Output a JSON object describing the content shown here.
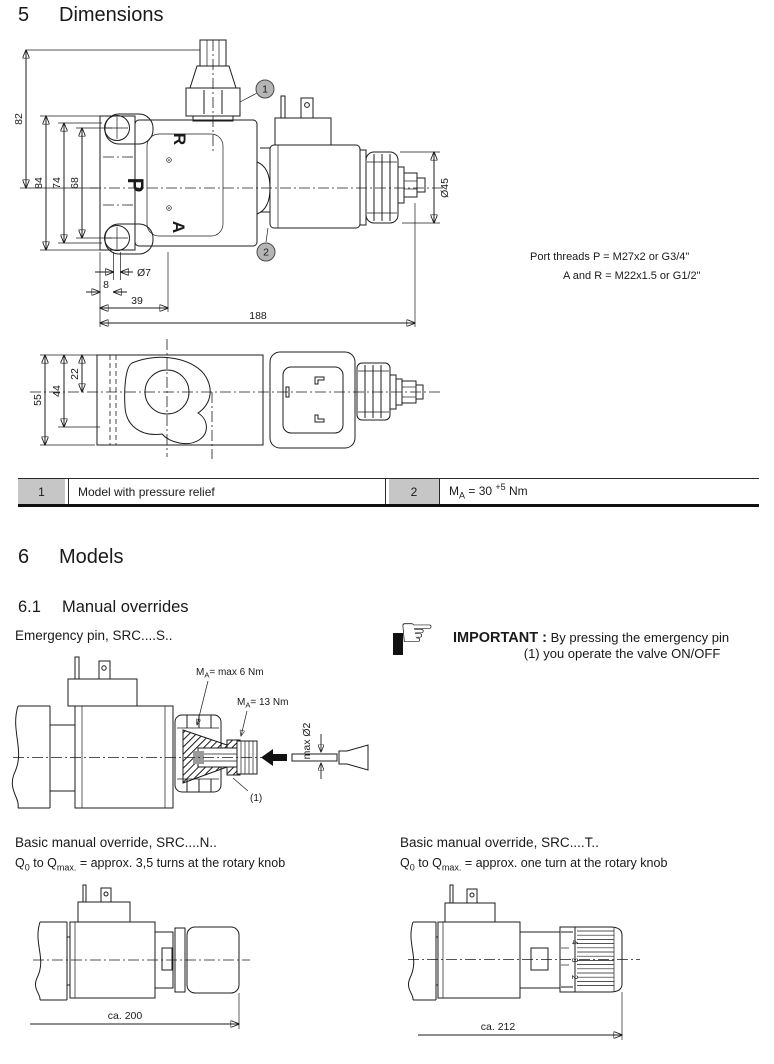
{
  "section5": {
    "number": "5",
    "title": "Dimensions"
  },
  "fig_front": {
    "dims": {
      "d82": "82",
      "d84": "84",
      "d74": "74",
      "d68": "68",
      "dia7": "Ø7",
      "d8": "8",
      "d39": "39",
      "d188": "188",
      "dia45": "Ø45"
    },
    "ports": {
      "r": "R",
      "p": "P",
      "a": "A"
    },
    "callout1": "1",
    "callout2": "2"
  },
  "port_threads": {
    "line1": "Port threads P = M27x2 or G3/4\"",
    "line2": "A and R = M22x1.5 or G1/2\""
  },
  "fig_top": {
    "dims": {
      "d55": "55",
      "d44": "44",
      "d22": "22"
    }
  },
  "legend": {
    "item1": {
      "num": "1",
      "text": "Model with pressure relief"
    },
    "item2": {
      "num": "2",
      "m": "M",
      "sub": "A",
      "eq": " = 30",
      "sup": "+5",
      "unit": " Nm"
    }
  },
  "section6": {
    "number": "6",
    "title": "Models"
  },
  "section61": {
    "number": "6.1",
    "title": "Manual overrides"
  },
  "emergency": {
    "title": "Emergency pin, SRC....S..",
    "torque1": {
      "m": "M",
      "sub": "A",
      "rest": "= max 6 Nm"
    },
    "torque2": {
      "m": "M",
      "sub": "A",
      "rest": "= 13 Nm"
    },
    "pin_dia": "max Ø2",
    "ref1": "(1)"
  },
  "important": {
    "label": "IMPORTANT :",
    "line1": " By pressing the emergency pin",
    "line2": "(1) you operate the valve ON/OFF"
  },
  "override_n": {
    "title": "Basic manual override, SRC....N..",
    "q": {
      "q1": "Q",
      "s1": "0",
      "mid": " to Q",
      "s2": "max.",
      "rest": " = approx. 3,5 turns at the rotary knob"
    },
    "dim": "ca. 200"
  },
  "override_t": {
    "title": "Basic manual override, SRC....T..",
    "q": {
      "q1": "Q",
      "s1": "0",
      "mid": " to Q",
      "s2": "max.",
      "rest": " = approx. one turn at the rotary knob"
    },
    "dim": "ca. 212",
    "scale": {
      "n4": "4",
      "n3": "3",
      "n2": "2"
    }
  }
}
